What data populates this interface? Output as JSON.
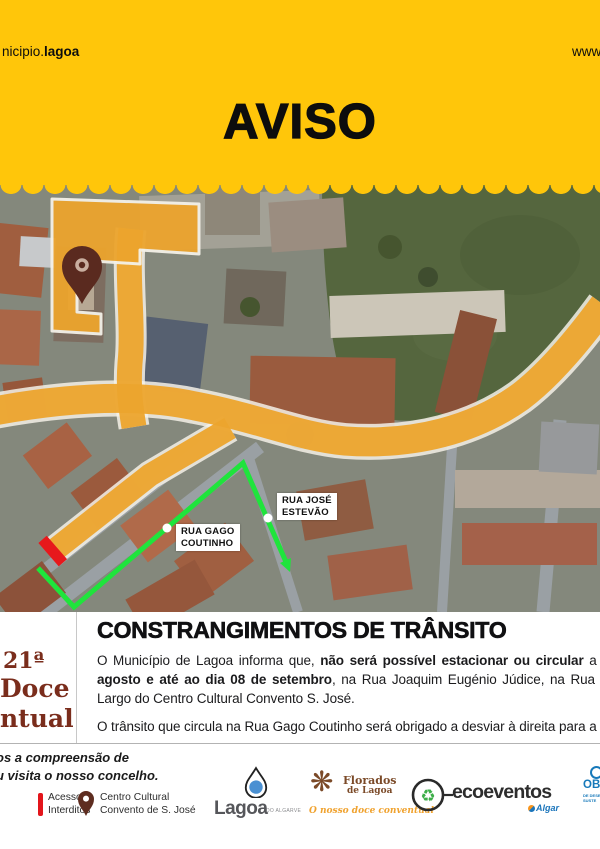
{
  "header": {
    "brand_prefix": "nicipio.",
    "brand_bold": "lagoa",
    "url": "www.",
    "title": "AVISO"
  },
  "map": {
    "label_jose": {
      "l1": "RUA JOSÉ",
      "l2": "ESTEVÃO"
    },
    "label_gago": {
      "l1": "RUA GAGO",
      "l2": "COUTINHO"
    }
  },
  "event_logo": {
    "l1": "21ª",
    "l2": "Doce",
    "l3": "ntual"
  },
  "notice": {
    "heading": "CONSTRANGIMENTOS DE TRÂNSITO",
    "p1_l1_a": "O Município de Lagoa informa que, ",
    "p1_l1_b": "não será possível estacionar ou circular",
    "p1_l1_c": " a partir d",
    "p1_l2_a": "agosto e até ao dia 08 de setembro",
    "p1_l2_b": ", na Rua Joaquim Eugénio Júdice, na Rua Sacadura",
    "p1_l3": "Largo do Centro Cultural Convento S. José.",
    "p2": "O trânsito que circula na Rua Gago Coutinho será obrigado a desviar à direita para a Rua J"
  },
  "footer": {
    "thanks_l1": "os a compreensão de",
    "thanks_l2": "u visita o nosso concelho.",
    "legend_interdito": {
      "l1": "Acessos",
      "l2": "Interditos"
    },
    "legend_centro": {
      "l1": "Centro Cultural",
      "l2": "Convento de S. José"
    },
    "logo_lagoa": {
      "name": "Lagoa",
      "sub": "DO ALGARVE"
    },
    "logo_florados": {
      "l1": "Florados",
      "l2": "de Lagoa",
      "tagline": "O nosso doce conventual"
    },
    "logo_eco": {
      "name": "ecoeventos",
      "sub": "Algar"
    },
    "logo_ods": {
      "l1": "OBJE",
      "l2": "DE DESEN",
      "l3": "SUSTE"
    }
  },
  "colors": {
    "header_yellow": "#ffc60a",
    "restricted_amber": "#eca42d",
    "detour_green": "#1fe43c",
    "closed_red": "#e7181c",
    "pin_maroon": "#5a2a1f",
    "event_maroon": "#7a2d1c"
  }
}
